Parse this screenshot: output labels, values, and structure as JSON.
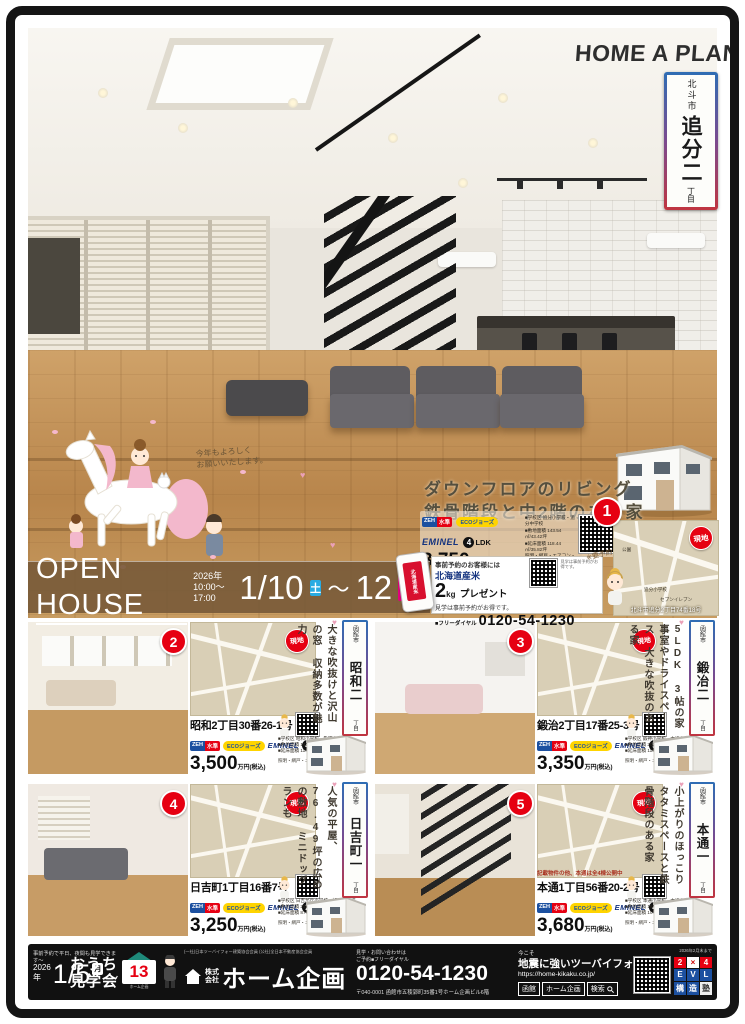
{
  "brand": "HOME A PLAN",
  "hero": {
    "banner": {
      "city": "北斗市",
      "name": "追分二",
      "chome": "丁目"
    },
    "greeting1": "今年もよろしく",
    "greeting2": "お願いいたします。",
    "catch1": "ダウンフロアのリビング",
    "catch2": "鉄骨階段と中2階のある家",
    "map_place1": "公園",
    "map_place2": "追分小学校",
    "map_place3": "セブンイレブン",
    "map_address": "北斗市追分2丁目74番18号"
  },
  "labels": {
    "zeh_l": "ZEH",
    "zeh_r": "水準",
    "eco": "ECOジョーズ",
    "brand": "EMINEL",
    "ldk": "LDK",
    "genchi": "現地",
    "price_unit": "万円(税込)"
  },
  "open_house": {
    "title": "OPEN HOUSE",
    "year": "2026年",
    "hours": "10:00～17:00",
    "date_start": "1/10",
    "day_start": "土",
    "tilde": "～",
    "date_end": "12",
    "day_end": "月・祝"
  },
  "promo": {
    "line1": "事前予約のお客様には",
    "gift": "北海道産米",
    "amount": "2",
    "unit": "kg",
    "present": "プレゼント",
    "note": "見学は事前予約がお得です。",
    "phone_label": "■フリーダイヤル",
    "phone": "0120-54-1230",
    "hand_note": "※要予約",
    "bag_label": "北海道産米"
  },
  "properties": [
    {
      "no": "1",
      "city": "北斗市",
      "district": "追分二",
      "chome": "丁目",
      "address": "北斗市追分2丁目74番18号",
      "price": "3,750",
      "ldk": "4",
      "school": "■学校区 追分小学校・追分中学校",
      "land": "■敷地面積 143.54㎡/43.42坪",
      "floor": "■延床面積 118.44㎡/35.82坪",
      "equip": "照明・網戸・エアコン・厚手カーテン付"
    },
    {
      "no": "2",
      "city": "函館市",
      "district": "昭和二",
      "chome": "丁目",
      "catch": "大きな吹抜けと沢山の窓 収納多数が魅力",
      "address": "昭和2丁目30番26-1号",
      "price": "3,500",
      "ldk": "4",
      "school": "■学校区 昭和小学校・亀田中学校",
      "land": "■敷地面積 143.76㎡/43.49坪",
      "floor": "■延床面積 114.89㎡/34.75坪",
      "equip": "照明・網戸・エアコン・厚手カーテン付"
    },
    {
      "no": "3",
      "city": "函館市",
      "district": "鍛冶二",
      "chome": "丁目",
      "catch": "5LDK 3帖の家事室やドライスペース 大きな吹抜のある家",
      "address": "鍛治2丁目17番25-3号",
      "price": "3,350",
      "ldk": "5",
      "school": "■学校区 鍛神小学校・本通中学校",
      "land": "■敷地面積 206.34㎡/62.42坪",
      "floor": "■延床面積 115.31㎡/34.88坪",
      "equip": "照明・網戸・エアコン・厚手カーテン付"
    },
    {
      "no": "4",
      "city": "函館市",
      "district": "日吉町一",
      "chome": "丁目",
      "catch": "人気の平屋、76.49坪の広めの敷地 ミニドッグランも",
      "address": "日吉町1丁目16番7号",
      "price": "3,250",
      "ldk": "2",
      "school": "■学校区 日吉が丘小学校・旭岡中学校",
      "land": "■敷地面積 252.89㎡/76.49坪",
      "floor": "■延床面積 87.36㎡/26.43坪",
      "equip": "照明・網戸・エアコン・厚手カーテン付"
    },
    {
      "no": "5",
      "city": "函館市",
      "district": "本通一",
      "chome": "丁目",
      "catch": "小上がりのほっこりタタミスペースと鉄骨階段のある家",
      "note": "記載物件の他、本通は全4棟公開中",
      "address": "本通1丁目56番20-2号",
      "price": "3,680",
      "ldk": "4",
      "school": "■学校区 本通小学校・本通中学校",
      "land": "■敷地面積 184.36㎡/55.77坪",
      "floor": "■延床面積 107.65㎡/32.56坪",
      "equip": "照明・網戸・エアコン・厚手カーテン付"
    }
  ],
  "footer": {
    "pre_note": "事前予約で平日、夜間も見学できます～",
    "year": "2026年",
    "date": "1/5",
    "day": "月",
    "tilde": "～",
    "event1": "おうち",
    "event2": "見学会",
    "logo13": "13",
    "logo13_caption": "ホーム企画",
    "member_line": "(一社)日本ツーバイフォー建築協会会員 (公社)全日本不動産協会会員",
    "company_prefix1": "株式",
    "company_prefix2": "会社",
    "company": "ホーム企画",
    "contact_label1": "見学・お問い合わせは",
    "contact_label2": "ご予約■フリーダイヤル",
    "phone": "0120-54-1230",
    "address": "〒040-0001 函館市五稜郭町35番1号ホーム企画ビル6階",
    "now": "今こそ",
    "slogan": "地震に強いツーバイフォー",
    "url": "https://home-kikaku.co.jp/",
    "search_term1": "函館",
    "search_term2": "ホーム企画",
    "search_label": "検索",
    "qr_note": "2026年2月末まで",
    "badge_grid": [
      "2",
      "×",
      "4",
      "E",
      "V",
      "L",
      "構",
      "造",
      "塾"
    ]
  }
}
